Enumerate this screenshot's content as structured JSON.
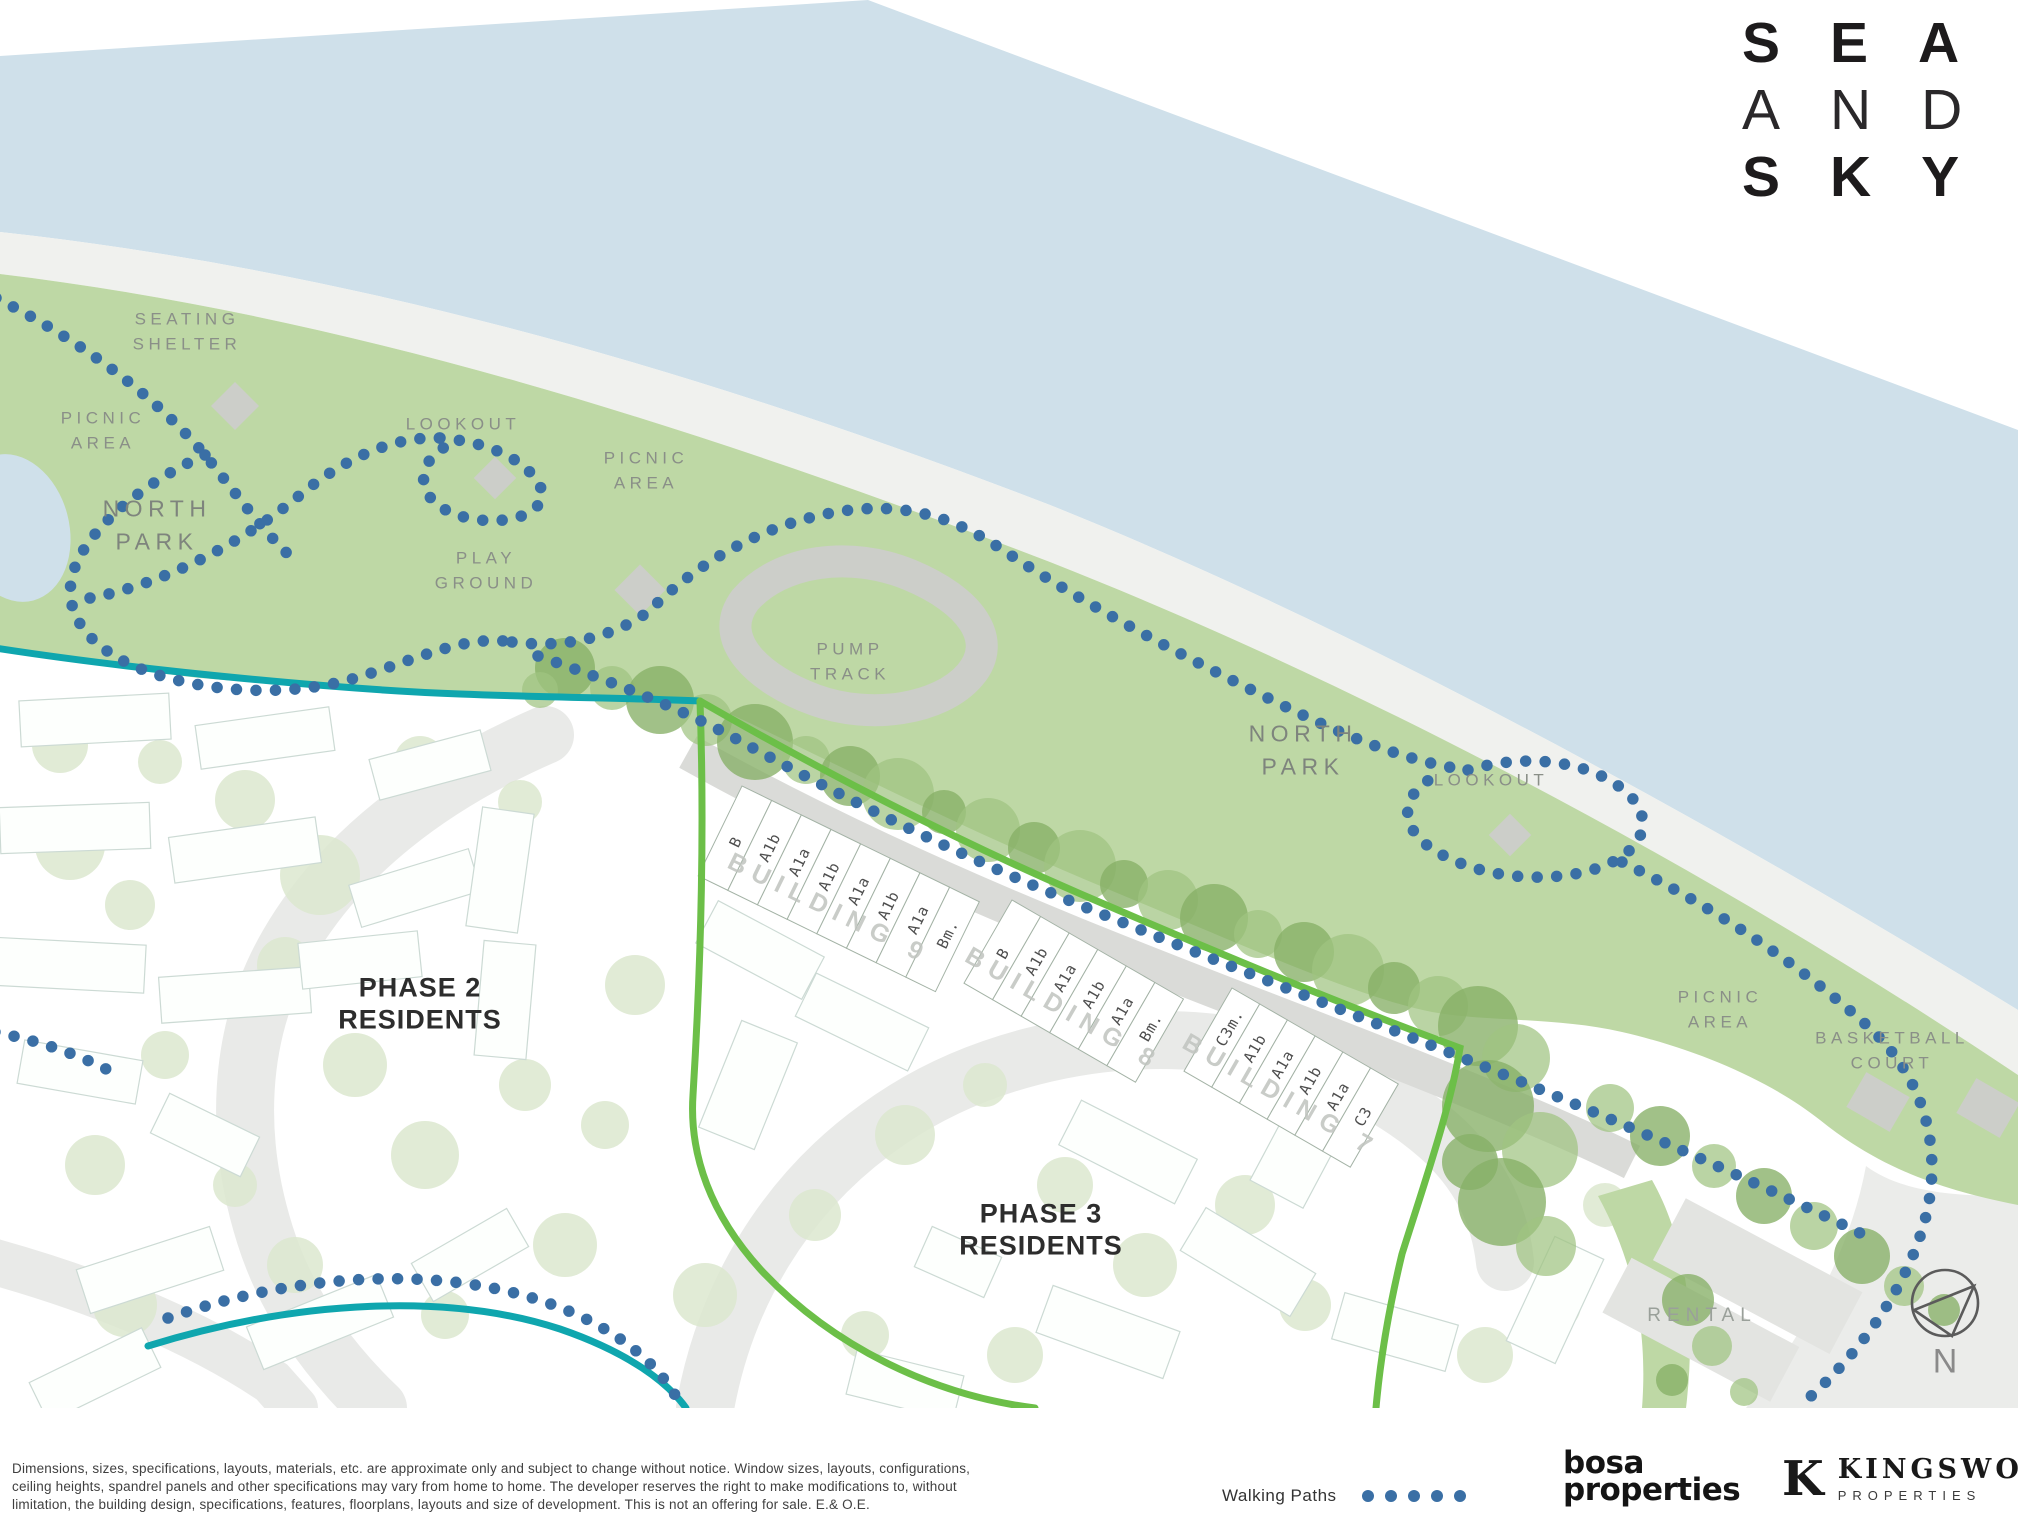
{
  "logo": {
    "line1": "SEA",
    "line2": "AND",
    "line3": "SKY"
  },
  "map": {
    "labels": {
      "seating_shelter": "SEATING\nSHELTER",
      "picnic_area_1": "PICNIC\nAREA",
      "north_park_1": "NORTH\nPARK",
      "lookout_1": "LOOKOUT",
      "play_ground": "PLAY\nGROUND",
      "picnic_area_2": "PICNIC\nAREA",
      "pump_track": "PUMP\nTRACK",
      "north_park_2": "NORTH\nPARK",
      "lookout_2": "LOOKOUT",
      "picnic_area_3": "PICNIC\nAREA",
      "basketball_court": "BASKETBALL\nCOURT",
      "rental": "RENTAL",
      "phase_2": "PHASE 2\nRESIDENTS",
      "phase_3": "PHASE 3\nRESIDENTS",
      "north": "N"
    },
    "buildings": [
      {
        "name": "BUILDING 9",
        "units": [
          "B",
          "A1b",
          "A1a",
          "A1b",
          "A1a",
          "A1b",
          "A1a",
          "Bm."
        ]
      },
      {
        "name": "BUILDING 8",
        "units": [
          "B",
          "A1b",
          "A1a",
          "A1b",
          "A1a",
          "Bm."
        ]
      },
      {
        "name": "BUILDING 7",
        "units": [
          "C3m.",
          "A1b",
          "A1a",
          "A1b",
          "A1a",
          "C3"
        ]
      }
    ],
    "colors": {
      "water": "#cfe0ea",
      "beach": "#f0f1ee",
      "park": "#bed8a5",
      "dots": "#3a6fa5",
      "teal": "#0fa6ae",
      "greenline": "#6cbf48",
      "tree": "#86b066",
      "treelight": "#9fc381",
      "ghosttree": "#dce8cf",
      "amenity": "#cccec9",
      "road": "#e9eae8",
      "promenade": "#dadbd8",
      "ghoststroke": "#ccdad4"
    }
  },
  "footer": {
    "disclaimer_lines": [
      "Dimensions, sizes, specifications, layouts, materials, etc. are approximate only and subject to change without notice. Window sizes, layouts, configurations,",
      "ceiling heights, spandrel panels and other specifications may vary from home to home. The developer reserves the right to make modifications to, without",
      "limitation, the building design, specifications, features, floorplans, layouts and size of development. This is not an offering for sale. E.& O.E."
    ],
    "legend_label": "Walking Paths",
    "bosa_logo": {
      "line1": "bosa",
      "line2": "properties"
    },
    "kingswood_logo": {
      "monogram": "K",
      "name": "KINGSWOOD",
      "subtitle": "PROPERTIES"
    }
  }
}
